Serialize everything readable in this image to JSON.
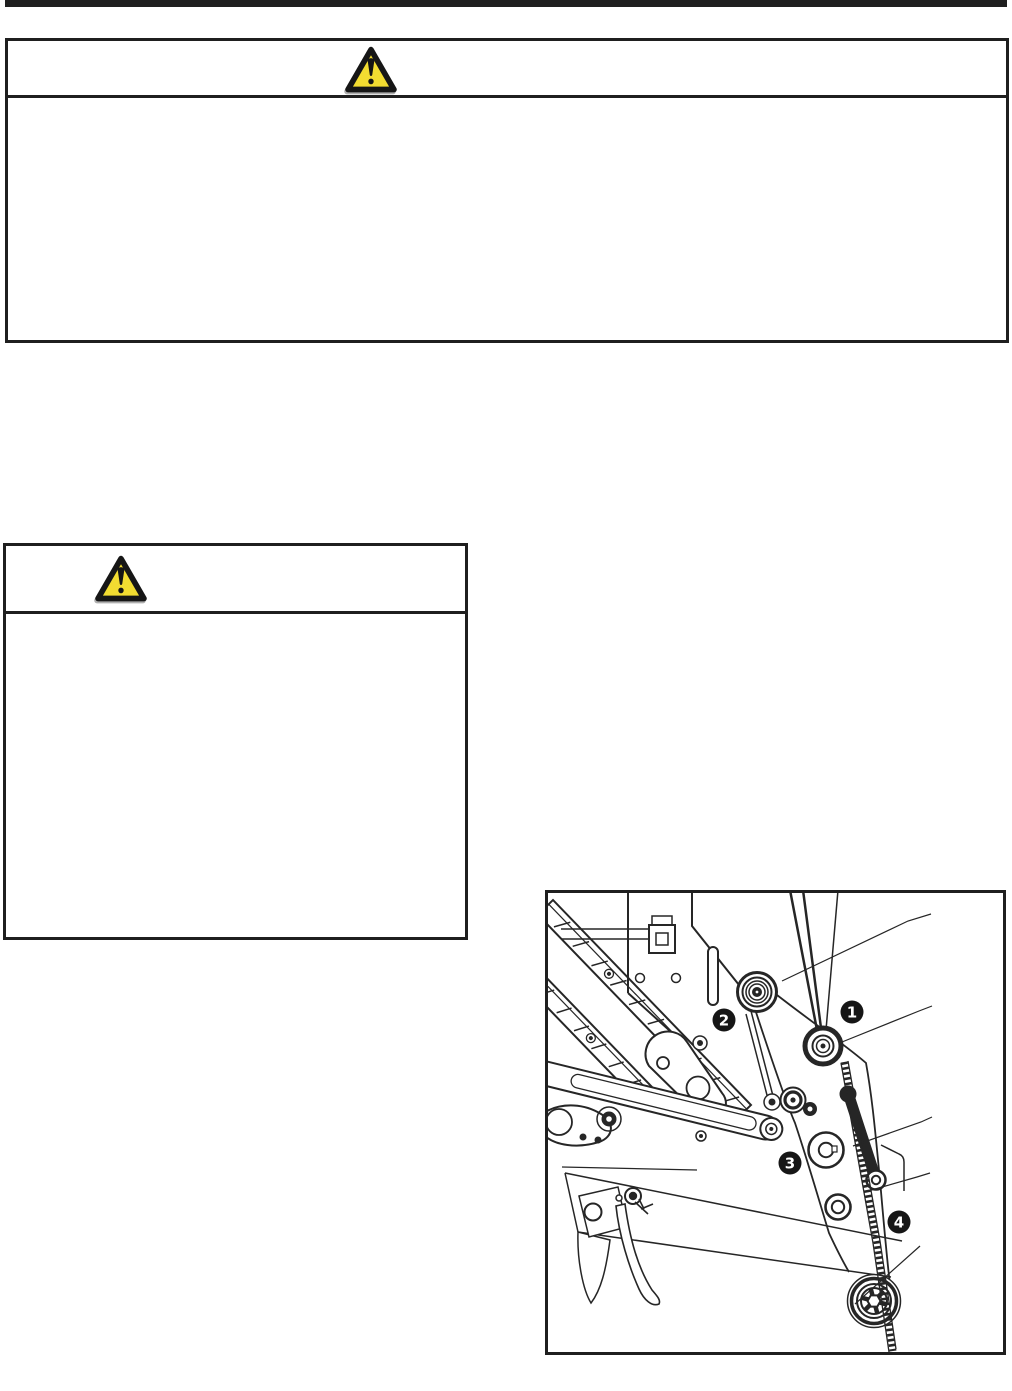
{
  "page": {
    "background_color": "#ffffff",
    "ink_color": "#1f1f1f"
  },
  "top_rule": {
    "color": "#1f1f1f"
  },
  "warning_large": {
    "icon": "warning-triangle",
    "triangle_fill": "#f2dc31",
    "triangle_border": "#161616",
    "header_text": "",
    "body_text": ""
  },
  "warning_small": {
    "icon": "warning-triangle",
    "triangle_fill": "#f2dc31",
    "triangle_border": "#161616",
    "header_text": "",
    "body_text": ""
  },
  "diagram": {
    "description": "Black-and-white line illustration of a pulley, belt and linkage mechanism with four numbered callouts and leader lines",
    "callouts": [
      {
        "number": "1"
      },
      {
        "number": "2"
      },
      {
        "number": "3"
      },
      {
        "number": "4"
      }
    ]
  }
}
